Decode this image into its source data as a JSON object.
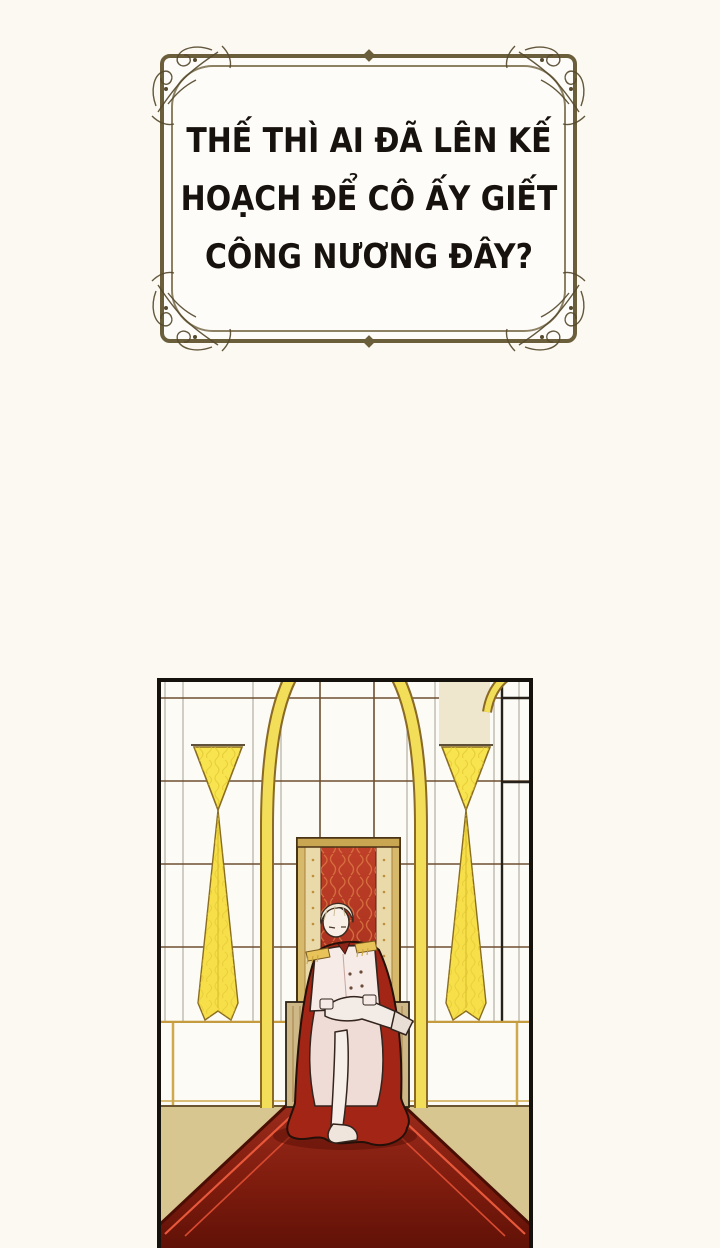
{
  "dialogue": {
    "lines": [
      "THẾ THÌ AI ĐÃ LÊN KẾ",
      "HOẠCH ĐỂ CÔ ẤY GIẾT",
      "CÔNG NƯƠNG ĐÂY?"
    ]
  },
  "colors": {
    "page_background": "#fbf9f2",
    "frame_outer": "#6b5e3b",
    "frame_inner_line": "#8d8164",
    "text": "#17120e",
    "panel_border": "#15110d",
    "wall_white": "#fcfbf6",
    "grid_brown": "#6e4f30",
    "arch_gold": "#f2de58",
    "curtain_yellow": "#f8e44e",
    "cream_pillar": "#eee6cd",
    "throne_gold_frame": "#d7b96b",
    "throne_red_fabric": "#b5301f",
    "armrest_wood": "#cfb888",
    "cloak_red": "#a22516",
    "carpet_red": "#8e2113",
    "carpet_stripe": "#e8583a",
    "floor_tan": "#d8c691"
  }
}
